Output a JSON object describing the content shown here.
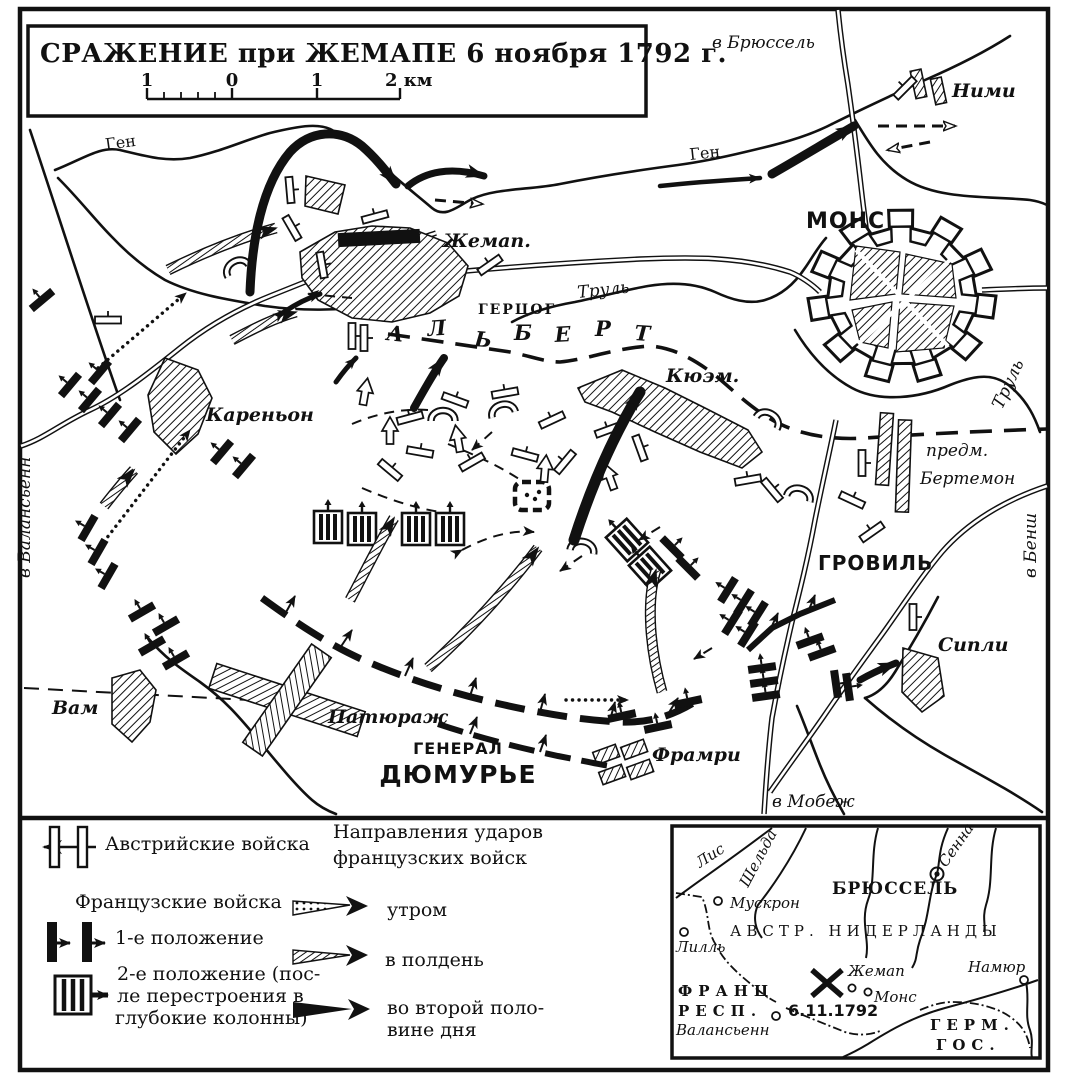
{
  "title": {
    "text": "СРАЖЕНИЕ при ЖЕМАПЕ 6 ноября 1792 г."
  },
  "scale_bar": {
    "labels": [
      "1",
      "0",
      "1",
      "2 км"
    ]
  },
  "map_labels": {
    "to_brussels": "в Брюссель",
    "nimy": "Ними",
    "mons": "МОНС",
    "gen_river_west": "Ген",
    "gen_river_east": "Ген",
    "jemappes": "Жемап.",
    "gercog": "ГЕРЦОГ",
    "albert_letters": [
      "А",
      "Л",
      "Ь",
      "Б",
      "Е",
      "Р",
      "Т"
    ],
    "trouille_center": "Труль",
    "trouille_east": "Труль",
    "cuesmes": "Кюэм.",
    "quaregnon": "Кареньон",
    "to_valenciennes": "в Валансьенн",
    "wasmes": "Вам",
    "paturages": "Патюраж",
    "general_line1": "ГЕНЕРАЛ",
    "general_line2": "ДЮМУРЬЕ",
    "frameries": "Фрамри",
    "to_maubeuge": "в Мобеж",
    "ciply": "Сипли",
    "grovil": "ГРОВИЛЬ",
    "bertaimont_line1": "предм.",
    "bertaimont_line2": "Бертемон",
    "to_binche": "в Бенш"
  },
  "legend": {
    "austrian": "Австрийские войска",
    "directions_line1": "Направления ударов",
    "directions_line2": "французских войск",
    "french": "Французские войска",
    "pos1": "1-е положение",
    "pos2_line1": "2-е положение (пос-",
    "pos2_line2": "ле перестроения в",
    "pos2_line3": "глубокие колонны)",
    "morning": "утром",
    "noon": "в полдень",
    "afternoon_line1": "во второй поло-",
    "afternoon_line2": "вине дня"
  },
  "inset": {
    "river_lys": "Лис",
    "river_scheldt": "Шельда",
    "river_senne": "Сенна",
    "brussels": "БРЮССЕЛЬ",
    "mouscron": "Мускрон",
    "lille": "Лилль",
    "austrian_netherlands": "АВСТР. НИДЕРЛАНДЫ",
    "namur": "Намюр",
    "jemappes": "Жемап",
    "mons": "Монс",
    "france_line1": "ФРАНЦ",
    "france_line2": "РЕСП.",
    "valenciennes": "Валансьенн",
    "battle_date": "6.11.1792",
    "germany_line1": "ГЕРМ.",
    "germany_line2": "ГОС."
  },
  "colors": {
    "ink": "#111111",
    "paper": "#ffffff"
  }
}
